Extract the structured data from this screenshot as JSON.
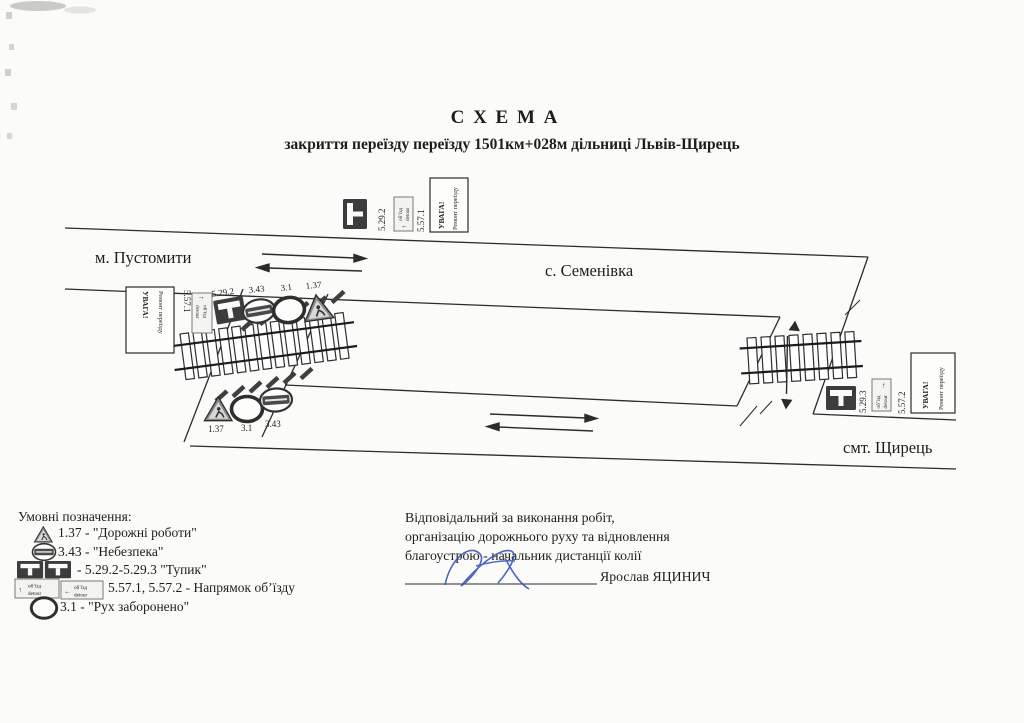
{
  "document": {
    "title": "С Х Е М А",
    "subtitle": "закриття переїзду переїзду 1501км+028м дільниці Львів-Щирець"
  },
  "places": {
    "pustomyty": "м. Пустомити",
    "semenivka": "с. Семенівка",
    "shchyrets": "смт. Щирець"
  },
  "warning_box": {
    "title": "УВАГА!",
    "subtitle": "Ремонт переїзду"
  },
  "detour_sign": {
    "top": "об’їзд",
    "bottom": "detour",
    "arrow_up": "↑",
    "arrow_left": "←",
    "arrow_right": "→"
  },
  "signs": {
    "top_cluster": {
      "dead_end": "5.29.2",
      "detour": "5.57.1"
    },
    "left_cluster": {
      "detour": "5.57.1",
      "dead_end": "5.29.2",
      "danger": "3.43",
      "no_entry": "3.1",
      "roadworks": "1.37"
    },
    "lower_cluster": {
      "roadworks": "1.37",
      "no_entry": "3.1",
      "danger": "3.43"
    },
    "right_cluster": {
      "dead_end": "5.29.3",
      "detour": "5.57.2"
    }
  },
  "legend": {
    "heading": "Умовні позначення:",
    "items": [
      {
        "label": "1.37 - \"Дорожні роботи\""
      },
      {
        "label": "3.43 - \"Небезпека\""
      },
      {
        "label": "- 5.29.2-5.29.3 \"Тупик\""
      },
      {
        "label": "5.57.1, 5.57.2 - Напрямок об’їзду"
      },
      {
        "label": "3.1 - \"Рух заборонено\""
      }
    ]
  },
  "responsible": {
    "line1": "Відповідальний за виконання робіт,",
    "line2": "організацію дорожнього руху та відновлення",
    "line3": "благоустрою - начальник дистанції колії",
    "name": "Ярослав ЯЦИНИЧ"
  },
  "colors": {
    "ink": "#2b2b2b",
    "paper": "#fbfbf9",
    "sign_dark": "#3c3c3c",
    "signature_blue": "#3a55b8"
  }
}
